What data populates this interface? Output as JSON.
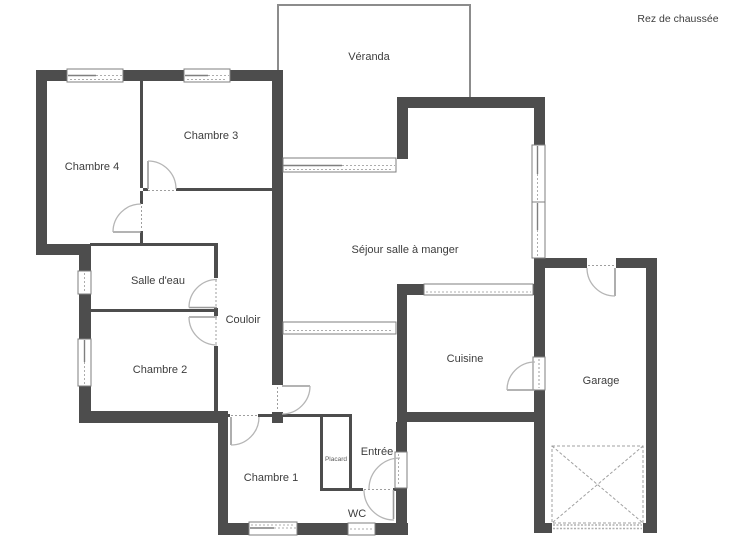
{
  "title": "Rez de chaussée",
  "colors": {
    "background": "#ffffff",
    "wall": "#4d4d4d",
    "veranda_wall": "#8c8c8c",
    "door_arc": "#b5b5b5",
    "window_border": "#7f7f7f",
    "label_text": "#3d3d3d",
    "dashed_storage": "#a0a0a0"
  },
  "rooms": {
    "veranda": "Véranda",
    "chambre3": "Chambre 3",
    "chambre4": "Chambre 4",
    "salle_deau": "Salle d'eau",
    "couloir": "Couloir",
    "chambre2": "Chambre 2",
    "sejour": "Séjour salle à manger",
    "cuisine": "Cuisine",
    "garage": "Garage",
    "chambre1": "Chambre 1",
    "placard": "Placard",
    "entree": "Entrée",
    "wc": "WC"
  }
}
